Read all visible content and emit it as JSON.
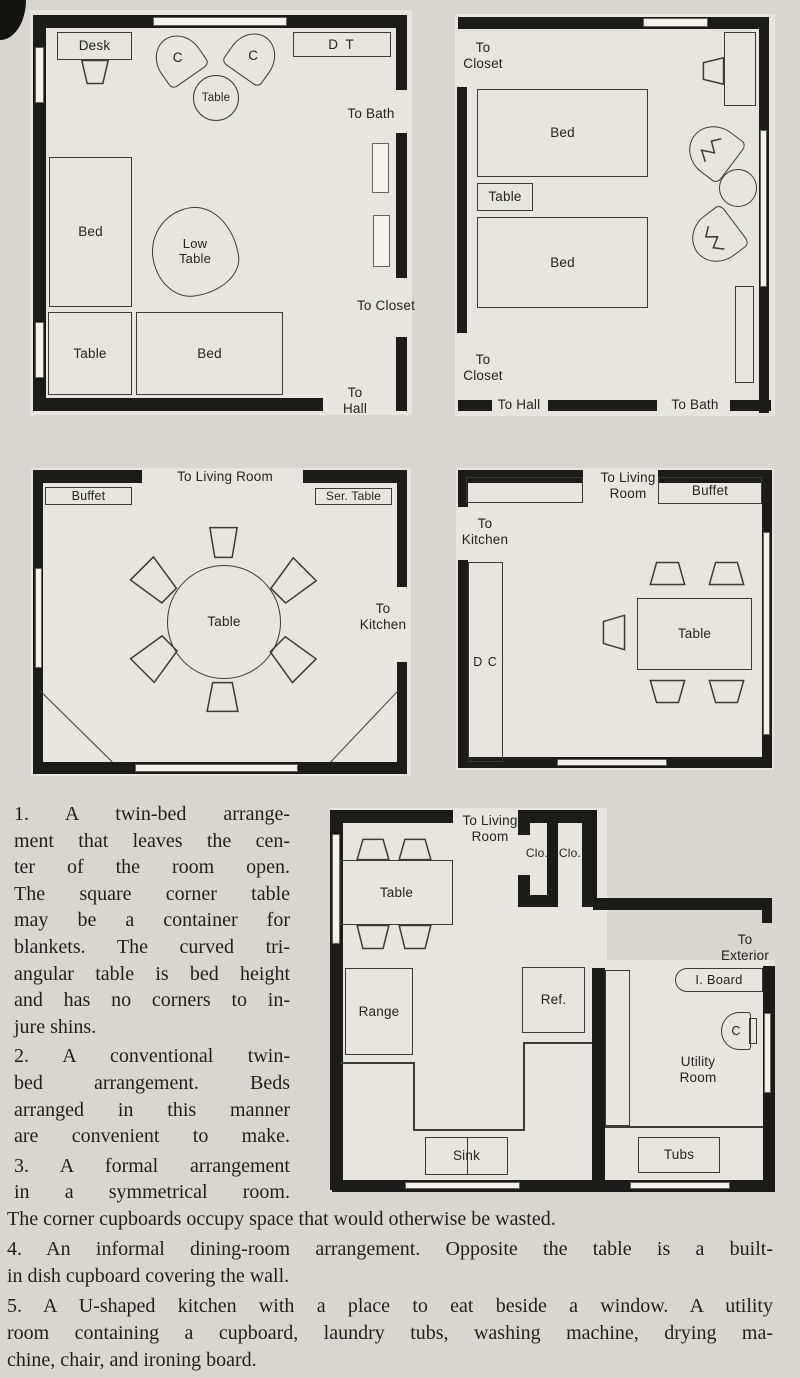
{
  "colors": {
    "page_bg": "#d7d6d1",
    "plan_bg": "#e6e5e0",
    "wall_ink": "#1b1b19",
    "line_ink": "#3b3b37"
  },
  "plans": {
    "p1": {
      "desk": "Desk",
      "chair_left": "C",
      "chair_right": "C",
      "round_table": "Table",
      "dressing_table": "D T",
      "to_bath": "To Bath",
      "to_closet": "To Closet",
      "to_hall": "To Hall",
      "bed_side": "Bed",
      "low_table": "Low Table",
      "corner_table": "Table",
      "bed_bottom": "Bed"
    },
    "p2": {
      "to_closet_top": "To Closet",
      "bed_top": "Bed",
      "table": "Table",
      "bed_bottom": "Bed",
      "to_closet_bottom": "To Closet",
      "to_hall": "To Hall",
      "to_bath": "To Bath"
    },
    "p3": {
      "buffet": "Buffet",
      "to_living_room": "To Living Room",
      "ser_table": "Ser. Table",
      "table": "Table",
      "to_kitchen": "To Kitchen"
    },
    "p4": {
      "to_living_room": "To Living Room",
      "to_kitchen": "To Kitchen",
      "buffet": "Buffet",
      "dish_cupboard": "D C",
      "table": "Table"
    },
    "p5": {
      "to_living_room": "To Living Room",
      "table": "Table",
      "closet_left": "Clo.",
      "closet_right": "Clo.",
      "to_exterior": "To Exterior",
      "ironing_board": "I. Board",
      "chair": "C",
      "utility_room": "Utility Room",
      "range": "Range",
      "refrigerator": "Ref.",
      "sink": "Sink",
      "tubs": "Tubs"
    }
  },
  "captions": {
    "column": [
      "1. A twin-bed arrange-",
      "ment that leaves the cen-",
      "ter of the room open.",
      "The square corner table",
      "may be a container for",
      "blankets. The curved tri-",
      "angular table is bed height",
      "and has no corners to in-",
      "jure shins.",
      "2. A conventional twin-",
      "bed arrangement. Beds",
      "arranged in this manner",
      "are convenient to make.",
      "3. A formal arrangement",
      "in a symmetrical room."
    ],
    "bottom": [
      "The corner cupboards occupy space that would otherwise be wasted.",
      "4. An informal dining-room arrangement. Opposite the table is a built-",
      "in dish cupboard covering the wall.",
      "5. A U-shaped kitchen with a place to eat beside a window. A utility",
      "room containing a cupboard, laundry tubs, washing machine, drying ma-",
      "chine, chair, and ironing board."
    ]
  }
}
